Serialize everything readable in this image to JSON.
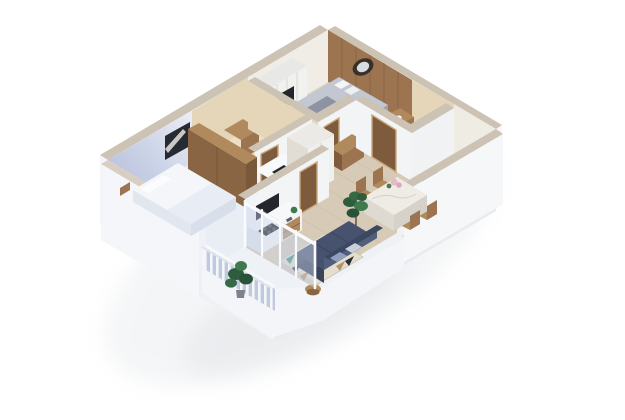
{
  "meta": {
    "description": "3D isometric cutaway floor-plan render of a one-bedroom apartment, white background, no text labels",
    "background": "#ffffff"
  },
  "palette": {
    "white_wall": "#f3f4f6",
    "white_outer": "#f6f7f9",
    "wall_top": "#cdc3b4",
    "periwinkle": "#b7c1dc",
    "periwinkle_light": "#e2e7f2",
    "wood": "#9c7450",
    "wood_dark": "#7d5b3c",
    "wood_light": "#b08a5c",
    "wood_floor": "#d7cbb7",
    "plank_line": "#c6b9a4",
    "beige_wall": "#e5d6ba",
    "beige_floor": "#ecdfc6",
    "bedroom_floor": "#e9edf4",
    "balcony_floor": "#eef1f6",
    "glass_blue": "#c3cfe8",
    "sofa_navy": "#47536e",
    "sofa_dark": "#39445c",
    "rug_base": "#e4decf",
    "rug_teal": "#3e8a77",
    "rug_black": "#2b2e33",
    "rug_tan": "#b09468",
    "plant_green": "#2f5c3c",
    "plant_green_light": "#3f7a4f",
    "dark_panel": "#24262b",
    "marble": "#efece6",
    "flower_pink": "#e7bac9",
    "bedding_grey": "#c2c7d1",
    "bedding_throw": "#8d93a1",
    "slat_blue": "#b6c2da"
  },
  "rooms": [
    {
      "id": "master-bedroom",
      "label": "Master Bedroom",
      "items": [
        "double bed with white bedding",
        "dark abstract wall artwork",
        "tall wooden wardrobe",
        "corner window"
      ]
    },
    {
      "id": "balcony",
      "label": "Balcony",
      "items": [
        "slatted railing",
        "potted plant",
        "sliding glass doors"
      ]
    },
    {
      "id": "living-room",
      "label": "Living Room",
      "items": [
        "navy sofa with cushions",
        "geometric triangle rug",
        "dark tv / appliance panel",
        "counter with black hob",
        "wooden media console"
      ]
    },
    {
      "id": "dining-area",
      "label": "Dining Area",
      "items": [
        "marble-top dining table",
        "pink flower centerpiece",
        "four wooden chairs",
        "tall indoor plant"
      ]
    },
    {
      "id": "kitchen",
      "label": "Kitchen",
      "items": [
        "white counter run",
        "black countertop appliance",
        "tall white cabinet units"
      ]
    },
    {
      "id": "bathroom-1",
      "label": "Bathroom 1",
      "items": [
        "beige walls",
        "walnut doors",
        "wooden vanity",
        "white shower unit"
      ]
    },
    {
      "id": "bedroom-2",
      "label": "Bedroom 2",
      "items": [
        "bed with grey bedding",
        "wood-panel headboard wall",
        "round wall mirror",
        "white wardrobe with dark inset",
        "wooden dresser"
      ]
    },
    {
      "id": "bathroom-2",
      "label": "Bathroom 2",
      "items": [
        "beige walls",
        "walnut door",
        "wooden vanity with basin",
        "toilet"
      ]
    },
    {
      "id": "entry-hallway",
      "label": "Entry Hallway",
      "items": [
        "gallery wall picture frames",
        "wooden console"
      ]
    }
  ]
}
